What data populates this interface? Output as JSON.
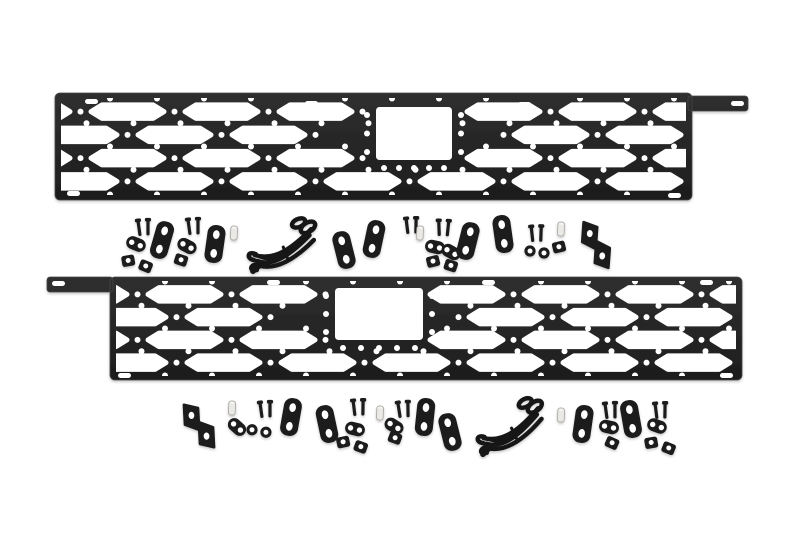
{
  "scene": {
    "description": "Product photo: two black modular hex-pattern MOLLE bed rail panels with mounting hardware kits (brackets, bolts, nut plates, washers, spacers, wiring harnesses) on a white background",
    "background": "#ffffff",
    "colors": {
      "panel": "#1d1d1d",
      "panel_light": "#2f2f2f",
      "panel_edge": "#474747",
      "hardware": "#1b1b1b",
      "wire": "#141414",
      "spacer_fill": "#ebe9e5",
      "spacer_edge": "#aeaca8",
      "hole": "#ffffff"
    }
  },
  "panels": [
    {
      "id": "molle-panel-top",
      "x": 55,
      "y": 93,
      "width": 637,
      "height": 107,
      "arm": {
        "side": "right",
        "x": 688,
        "y": 96,
        "width": 60,
        "height": 15
      },
      "stake": {
        "x": 376,
        "y": 107,
        "w": 76,
        "h": 53
      },
      "field": {
        "x": 63,
        "y": 100,
        "w": 621,
        "h": 93,
        "offset_even": 28,
        "offset_odd": -19
      },
      "hex_rows": 4,
      "slots": [
        {
          "x": 85,
          "y": 99
        },
        {
          "x": 305,
          "y": 101
        },
        {
          "x": 518,
          "y": 102
        },
        {
          "x": 731,
          "y": 101
        },
        {
          "x": 67,
          "y": 191
        },
        {
          "x": 668,
          "y": 193
        }
      ]
    },
    {
      "id": "molle-panel-bottom",
      "x": 110,
      "y": 277,
      "width": 632,
      "height": 103,
      "arm": {
        "side": "left",
        "x": 47,
        "y": 277,
        "width": 66,
        "height": 15
      },
      "stake": {
        "x": 335,
        "y": 288,
        "w": 88,
        "h": 52
      },
      "field": {
        "x": 118,
        "y": 283,
        "w": 616,
        "h": 91,
        "offset_even": 30,
        "offset_odd": -25
      },
      "hex_rows": 4,
      "slots": [
        {
          "x": 52,
          "y": 281
        },
        {
          "x": 267,
          "y": 280
        },
        {
          "x": 482,
          "y": 280
        },
        {
          "x": 700,
          "y": 280
        },
        {
          "x": 118,
          "y": 373
        },
        {
          "x": 720,
          "y": 373
        }
      ]
    }
  ],
  "hardware": {
    "kits": [
      {
        "id": "hardware-kit-top",
        "items": [
          {
            "type": "bolt-pair",
            "x": 139,
            "y": 228,
            "rot": -4
          },
          {
            "type": "nut-plate",
            "x": 136,
            "y": 244,
            "rot": 22
          },
          {
            "type": "clip-nut-pair",
            "x": 137,
            "y": 263,
            "rot": 8
          },
          {
            "type": "strap-bracket",
            "x": 162,
            "y": 240,
            "rot": 16
          },
          {
            "type": "bolt-pair",
            "x": 189,
            "y": 227,
            "rot": -4
          },
          {
            "type": "nut-plate",
            "x": 187,
            "y": 246,
            "rot": 28
          },
          {
            "type": "clip-nut",
            "x": 181,
            "y": 260,
            "rot": 18
          },
          {
            "type": "strap-bracket",
            "x": 215,
            "y": 244,
            "rot": 8
          },
          {
            "type": "spacer",
            "x": 234,
            "y": 233,
            "rot": 3
          },
          {
            "type": "wire-harness",
            "x": 284,
            "y": 243,
            "rot": -4
          },
          {
            "type": "strap-bracket",
            "x": 344,
            "y": 250,
            "rot": -14
          },
          {
            "type": "strap-bracket",
            "x": 374,
            "y": 239,
            "rot": 12
          },
          {
            "type": "bolt-pair",
            "x": 407,
            "y": 226,
            "rot": -3
          },
          {
            "type": "spacer",
            "x": 420,
            "y": 233,
            "rot": 4
          },
          {
            "type": "bolt-pair",
            "x": 439,
            "y": 228,
            "rot": 2
          },
          {
            "type": "nut-plate",
            "x": 435,
            "y": 247,
            "rot": 12
          },
          {
            "type": "nut-plate",
            "x": 451,
            "y": 252,
            "rot": 30
          },
          {
            "type": "clip-nut-pair",
            "x": 442,
            "y": 263,
            "rot": 4
          },
          {
            "type": "strap-bracket",
            "x": 468,
            "y": 241,
            "rot": 14
          },
          {
            "type": "strap-bracket",
            "x": 503,
            "y": 234,
            "rot": -8
          },
          {
            "type": "bolt-pair",
            "x": 532,
            "y": 234,
            "rot": -2
          },
          {
            "type": "washer-pair",
            "x": 537,
            "y": 251,
            "rot": 0
          },
          {
            "type": "spacer",
            "x": 561,
            "y": 229,
            "rot": 3
          },
          {
            "type": "clip-nut",
            "x": 559,
            "y": 247,
            "rot": -14
          },
          {
            "type": "z-bracket",
            "x": 596,
            "y": 245,
            "rot": 4
          }
        ]
      },
      {
        "id": "hardware-kit-bottom",
        "items": [
          {
            "type": "z-bracket",
            "x": 199,
            "y": 426,
            "rot": -3
          },
          {
            "type": "spacer",
            "x": 232,
            "y": 408,
            "rot": 2
          },
          {
            "type": "nut-plate",
            "x": 237,
            "y": 427,
            "rot": 42
          },
          {
            "type": "bolt-pair",
            "x": 261,
            "y": 410,
            "rot": -4
          },
          {
            "type": "washer-pair",
            "x": 259,
            "y": 430,
            "rot": 2
          },
          {
            "type": "strap-bracket",
            "x": 291,
            "y": 417,
            "rot": 10
          },
          {
            "type": "strap-bracket",
            "x": 327,
            "y": 424,
            "rot": -12
          },
          {
            "type": "bolt-pair",
            "x": 354,
            "y": 408,
            "rot": -3
          },
          {
            "type": "nut-plate",
            "x": 355,
            "y": 429,
            "rot": 14
          },
          {
            "type": "clip-nut-pair",
            "x": 352,
            "y": 444,
            "rot": 6
          },
          {
            "type": "spacer",
            "x": 380,
            "y": 413,
            "rot": 2
          },
          {
            "type": "bolt-pair",
            "x": 399,
            "y": 410,
            "rot": -5
          },
          {
            "type": "nut-plate",
            "x": 394,
            "y": 426,
            "rot": 32
          },
          {
            "type": "clip-nut",
            "x": 395,
            "y": 438,
            "rot": 20
          },
          {
            "type": "strap-bracket",
            "x": 425,
            "y": 417,
            "rot": 6
          },
          {
            "type": "strap-bracket",
            "x": 450,
            "y": 432,
            "rot": -14
          },
          {
            "type": "wire-harness",
            "x": 512,
            "y": 424,
            "rot": -8
          },
          {
            "type": "spacer",
            "x": 561,
            "y": 415,
            "rot": 2
          },
          {
            "type": "strap-bracket",
            "x": 583,
            "y": 424,
            "rot": 8
          },
          {
            "type": "bolt-pair",
            "x": 606,
            "y": 411,
            "rot": -4
          },
          {
            "type": "nut-plate",
            "x": 609,
            "y": 427,
            "rot": 12
          },
          {
            "type": "clip-nut",
            "x": 612,
            "y": 443,
            "rot": 24
          },
          {
            "type": "strap-bracket",
            "x": 631,
            "y": 419,
            "rot": -10
          },
          {
            "type": "bolt-pair",
            "x": 656,
            "y": 411,
            "rot": -3
          },
          {
            "type": "nut-plate",
            "x": 657,
            "y": 426,
            "rot": 20
          },
          {
            "type": "clip-nut-pair",
            "x": 660,
            "y": 445,
            "rot": 8
          }
        ]
      }
    ]
  }
}
